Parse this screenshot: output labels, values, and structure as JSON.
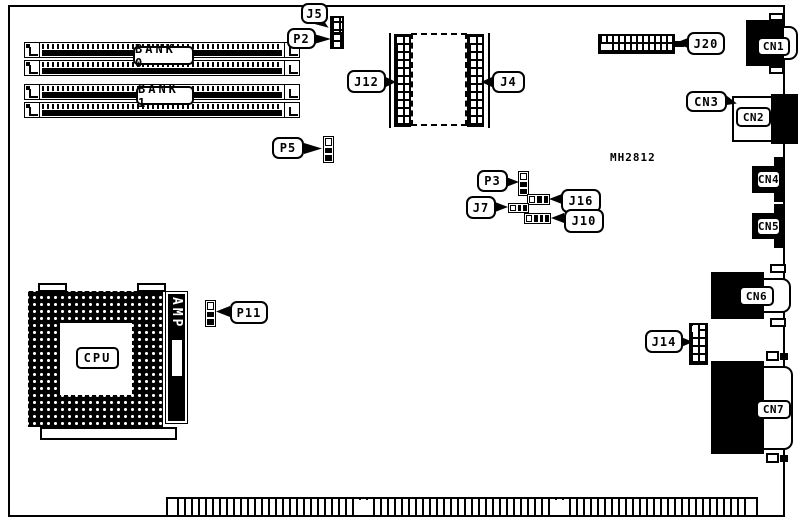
{
  "colors": {
    "ink": "#000000",
    "paper": "#ffffff"
  },
  "board": {
    "memory_banks": {
      "bank0": "BANK 0",
      "bank1": "BANK 1"
    },
    "cpu": {
      "label": "CPU",
      "socket": "AMP"
    },
    "chip_label": "MH2812",
    "callouts": {
      "j5": "J5",
      "p2": "P2",
      "j12": "J12",
      "j4": "J4",
      "j20": "J20",
      "cn3": "CN3",
      "p5": "P5",
      "p3": "P3",
      "j16": "J16",
      "j7": "J7",
      "j10": "J10",
      "p11": "P11",
      "j14": "J14"
    },
    "connectors": {
      "cn1": "CN1",
      "cn2": "CN2",
      "cn4": "CN4",
      "cn5": "CN5",
      "cn6": "CN6",
      "cn7": "CN7"
    }
  }
}
